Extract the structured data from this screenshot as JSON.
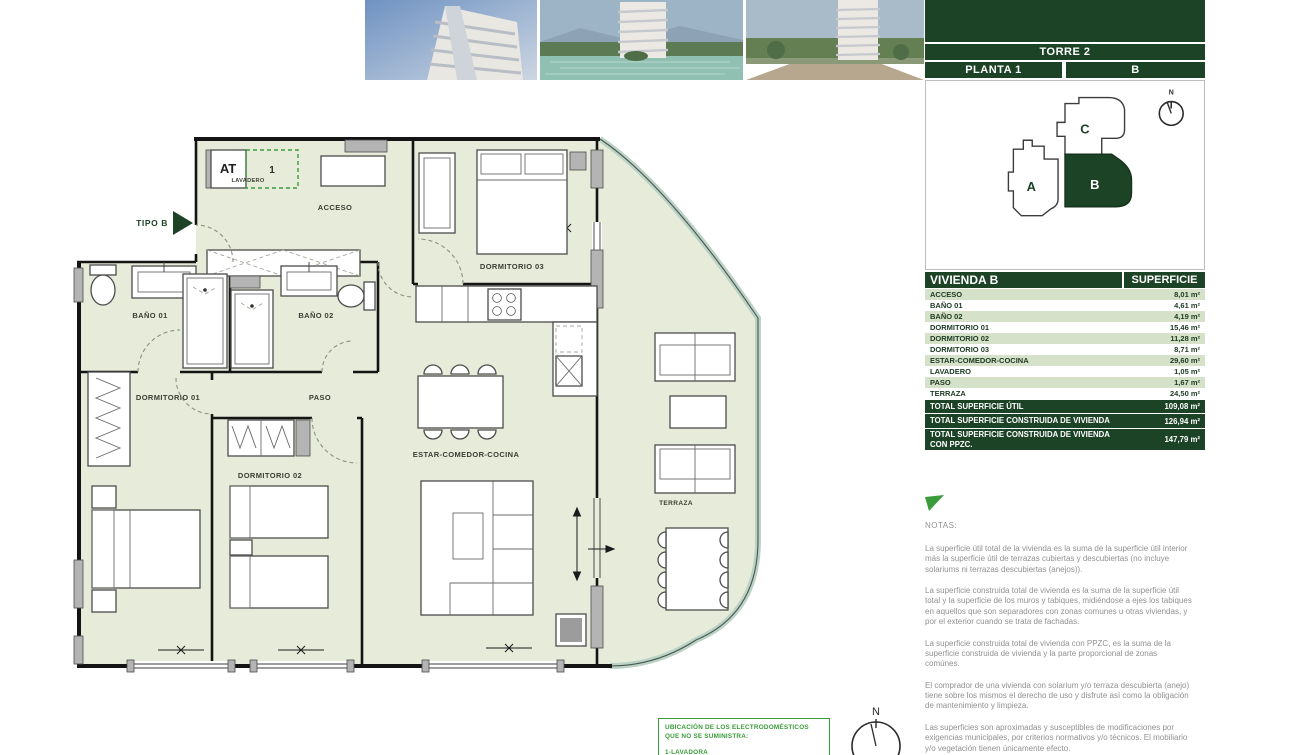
{
  "header": {
    "torre": "TORRE 2",
    "planta": "PLANTA 1",
    "letter": "B"
  },
  "keyplan": {
    "unit_a": "A",
    "unit_b": "B",
    "unit_c": "C",
    "north": "N"
  },
  "table": {
    "header": {
      "name": "VIVIENDA B",
      "surface": "SUPERFICIE"
    },
    "rows": [
      {
        "label": "ACCESO",
        "value": "8,01 m²"
      },
      {
        "label": "BAÑO 01",
        "value": "4,61 m²"
      },
      {
        "label": "BAÑO 02",
        "value": "4,19 m²"
      },
      {
        "label": "DORMITORIO 01",
        "value": "15,46 m²"
      },
      {
        "label": "DORMITORIO 02",
        "value": "11,28 m²"
      },
      {
        "label": "DORMITORIO 03",
        "value": "8,71 m²"
      },
      {
        "label": "ESTAR-COMEDOR-COCINA",
        "value": "29,60 m²"
      },
      {
        "label": "LAVADERO",
        "value": "1,05 m²"
      },
      {
        "label": "PASO",
        "value": "1,67 m²"
      },
      {
        "label": "TERRAZA",
        "value": "24,50 m²"
      }
    ],
    "totals": [
      {
        "label": "TOTAL SUPERFICIE ÚTIL",
        "value": "109,08 m²"
      },
      {
        "label": "TOTAL SUPERFICIE CONSTRUIDA DE VIVIENDA",
        "value": "126,94 m²"
      },
      {
        "label": "TOTAL SUPERFICIE CONSTRUIDA DE VIVIENDA CON PPZC.",
        "value": "147,79 m²"
      }
    ]
  },
  "notes": {
    "title": "NOTAS:",
    "paragraphs": [
      {
        "text": "La superficie útil total de la vivienda es la suma de la superficie útil interior más la superficie útil de terrazas cubiertas y descubiertas (no incluye solariums ni terrazas descubiertas (anejos))."
      },
      {
        "text": "La superficie construida total de vivienda es la suma de la superficie útil total y la superficie de los muros y tabiques, midiéndose a ejes los tabiques en aquellos que son separadores con zonas comunes u otras viviendas, y por el exterior cuando se trata de fachadas."
      },
      {
        "text": "La superficie construida total de vivienda con PPZC, es la suma de la superficie construida de vivienda y la parte proporcional de zonas comúnes."
      },
      {
        "text": "El comprador de una vivienda con solarium y/o terraza descubierta (anejo) tiene sobre los mismos el derecho de uso y disfrute así como la obligación de mantenimiento y limpieza."
      },
      {
        "text": "Las superficies son aproximadas y susceptibles de modificaciones por exigencias municipales, por criterios normativos y/o técnicos. El mobiliario y/o vegetación tienen únicamente efecto."
      }
    ]
  },
  "plan": {
    "tipo_label": "TIPO B",
    "labels": {
      "acceso": "ACCESO",
      "bano01": "BAÑO 01",
      "bano02": "BAÑO 02",
      "dormitorio01": "DORMITORIO 01",
      "dormitorio02": "DORMITORIO 02",
      "dormitorio03": "DORMITORIO 03",
      "estar": "ESTAR-COMEDOR-COCINA",
      "paso": "PASO",
      "terraza": "TERRAZA",
      "at": "AT",
      "lavadero": "LAVADERO",
      "appliance_1": "1"
    }
  },
  "footer": {
    "appliances_title": "UBICACIÓN DE LOS ELECTRODOMÉSTICOS QUE NO SE SUMINISTRA:",
    "appliances_item": "1-LAVADORA",
    "north": "N"
  },
  "colors": {
    "brand_dark_green": "#1d4326",
    "row_green": "#d5e1c8",
    "accent_green": "#3a9b3a",
    "plan_fill": "#e6ecd9"
  }
}
